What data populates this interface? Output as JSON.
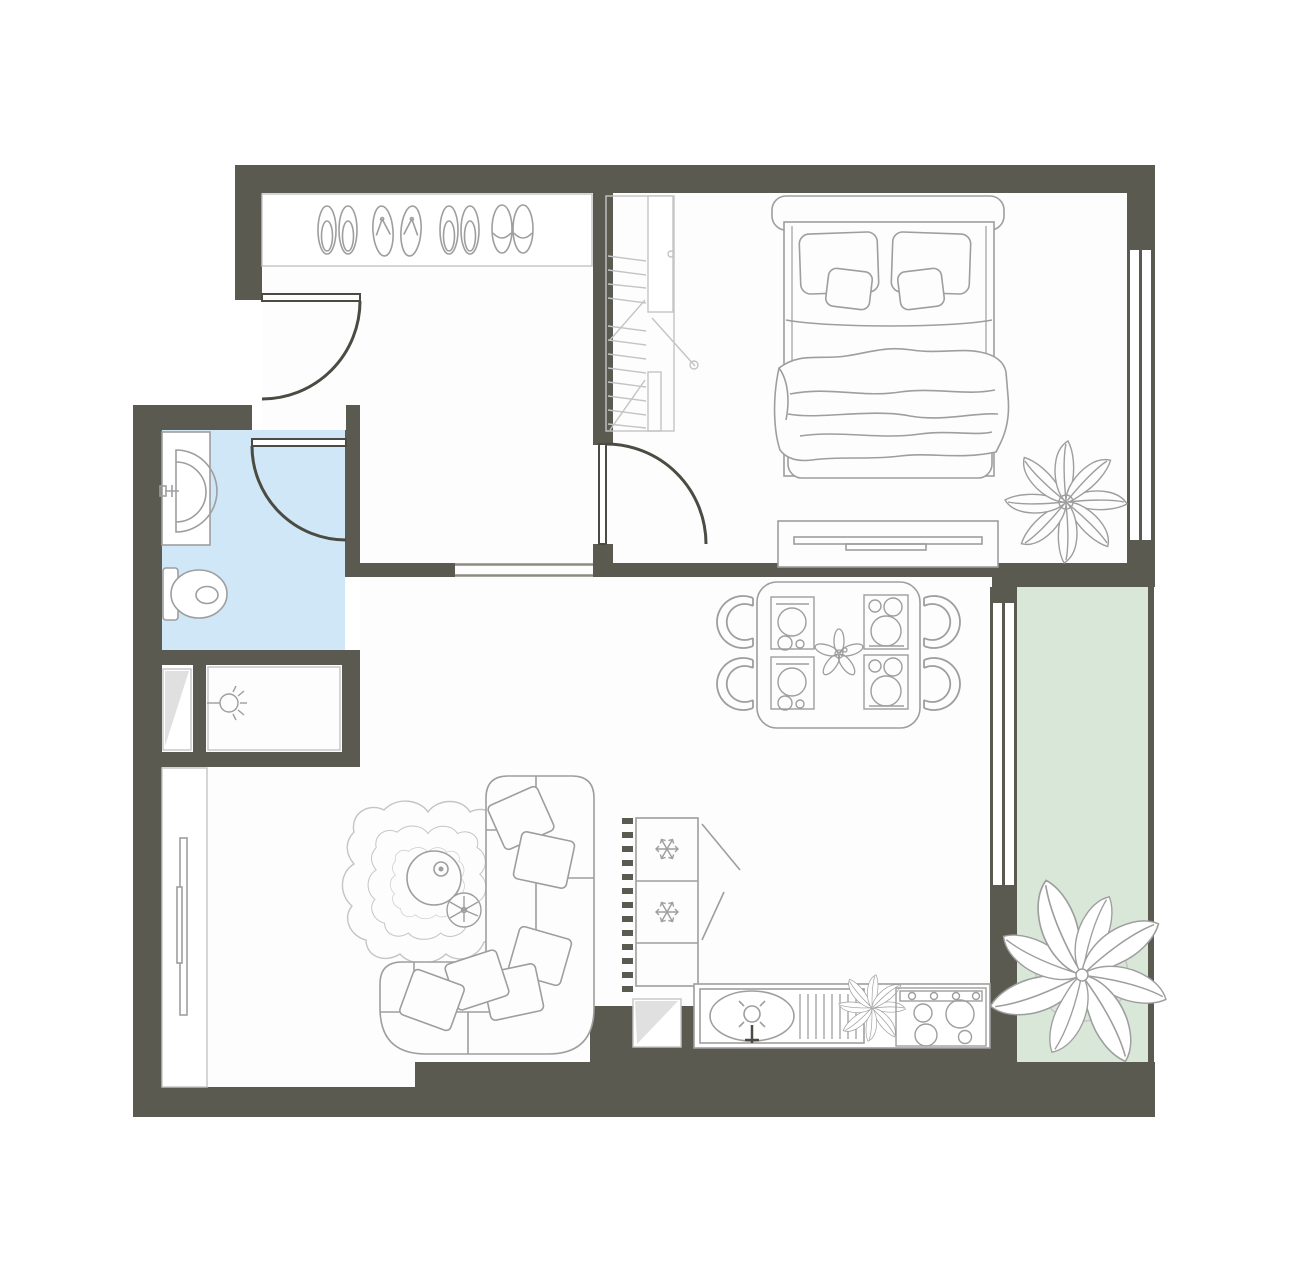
{
  "meta": {
    "type": "floor-plan",
    "view": "top-down",
    "description": "One-bedroom apartment floor plan with entry hall, bedroom, bathroom, shower room, open living room with kitchen-dining area and a balcony"
  },
  "colors": {
    "wall": "#5a5a50",
    "floor": "#fdfdfd",
    "bathroom": "#cfe7f6",
    "balcony": "#d9e7d8",
    "outline": "#9e9e9e",
    "outlineLight": "#c4c4c4",
    "doorDark": "#4b4b43",
    "shade": "#e0e0e0",
    "openLine": "#8c8c82"
  },
  "rooms": [
    {
      "id": "entry-hall",
      "items": [
        "shoe shelf",
        "pair of slippers",
        "pair of flip-flops",
        "pair of slippers",
        "pair of closed slippers",
        "entry door"
      ]
    },
    {
      "id": "bedroom",
      "items": [
        "open wardrobe with hanging clothes",
        "double bed with two pillows, two cushions and blanket",
        "tv stand",
        "potted plant",
        "window",
        "door"
      ]
    },
    {
      "id": "bathroom",
      "items": [
        "washbasin on counter",
        "toilet",
        "door"
      ],
      "floorColor": "blue"
    },
    {
      "id": "shower-room",
      "items": [
        "ceiling light"
      ]
    },
    {
      "id": "duct-shaft",
      "items": [
        "shaded shaft"
      ]
    },
    {
      "id": "living-room",
      "items": [
        "corner sofa with six cushions",
        "wavy rug",
        "round coffee table",
        "round side table with plant",
        "wall tv",
        "built-in closet"
      ]
    },
    {
      "id": "kitchen-dining",
      "items": [
        "dining table",
        "four chairs",
        "four place settings",
        "flower centerpiece",
        "fridge-freezer with two snowflake symbols",
        "kitchen counter",
        "oval sink with faucet",
        "dish drainer",
        "herb plant",
        "hob with four burners and knobs",
        "vent shaft"
      ]
    },
    {
      "id": "balcony",
      "items": [
        "large potted plant",
        "window wall",
        "railing"
      ],
      "floorColor": "green"
    }
  ]
}
